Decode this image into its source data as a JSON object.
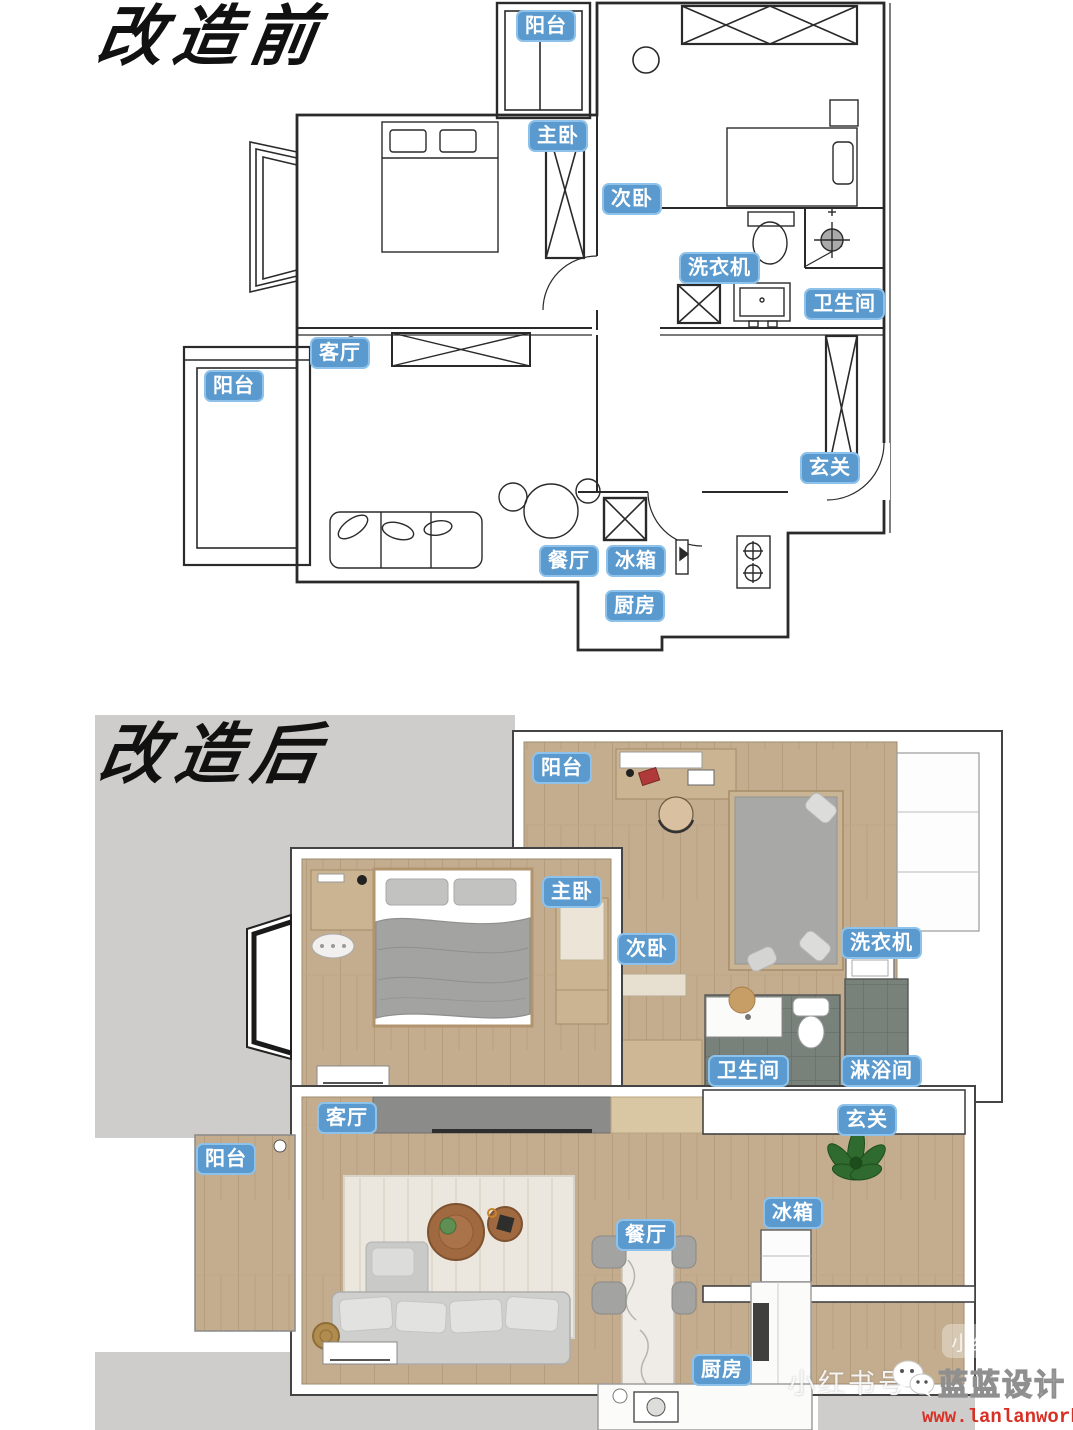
{
  "titles": {
    "before": "改造前",
    "after": "改造后"
  },
  "rooms": {
    "balcony": "阳台",
    "master_bedroom": "主卧",
    "second_bedroom": "次卧",
    "washing_machine": "洗衣机",
    "bathroom": "卫生间",
    "living_room": "客厅",
    "entry": "玄关",
    "dining_room": "餐厅",
    "fridge": "冰箱",
    "kitchen": "厨房",
    "shower_room": "淋浴间"
  },
  "watermark": {
    "account_prefix": "小红书号",
    "brand": "蓝蓝设计",
    "url": "www.lanlanwork.com",
    "badge": "小红书",
    "icon": "wechat-icon"
  },
  "colors": {
    "label_bg": "#5b9ace",
    "label_border": "#8ec2ea",
    "plan_line": "#2a2a2a",
    "wood_floor": "#c4ad8e",
    "bath_tile": "#79827a",
    "outside_gray": "#cecdcb",
    "marble": "#efece7",
    "furniture_gray": "#a8a8a6",
    "url_red": "#d93025"
  }
}
